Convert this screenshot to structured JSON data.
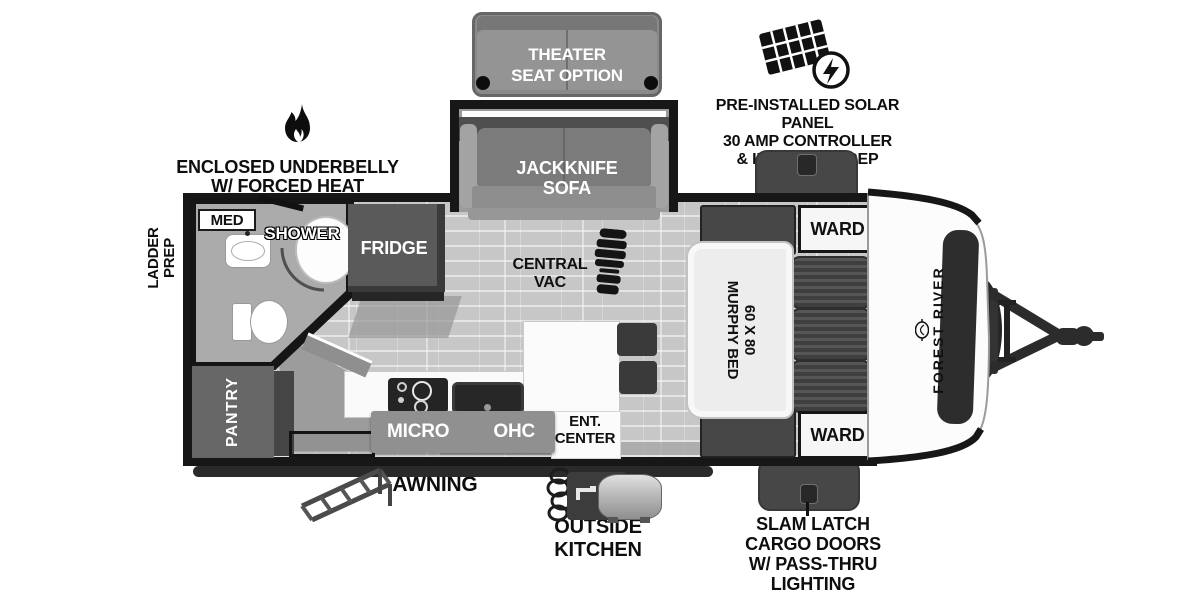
{
  "exterior": {
    "solar": {
      "line1": "PRE-INSTALLED SOLAR PANEL",
      "line2": "30 AMP CONTROLLER",
      "line3": "& INVERTER PREP"
    },
    "underbelly": {
      "line1": "ENCLOSED UNDERBELLY",
      "line2": "W/ FORCED HEAT"
    },
    "ladder": {
      "line1": "LADDER",
      "line2": "PREP"
    },
    "awning": "AWNING",
    "outside_kitchen": {
      "line1": "OUTSIDE",
      "line2": "KITCHEN"
    },
    "slam_latch": {
      "line1": "SLAM LATCH",
      "line2": "CARGO DOORS",
      "line3": "W/ PASS-THRU",
      "line4": "LIGHTING"
    },
    "brand": "FOREST RIVER"
  },
  "interior": {
    "theater": {
      "line1": "THEATER",
      "line2": "SEAT OPTION"
    },
    "jackknife": {
      "line1": "JACKKNIFE",
      "line2": "SOFA"
    },
    "central_vac": {
      "line1": "CENTRAL",
      "line2": "VAC"
    },
    "murphy": {
      "line1": "60 X 80",
      "line2": "MURPHY BED"
    },
    "ward_top": "WARD",
    "ward_bottom": "WARD",
    "med": "MED",
    "shower": "SHOWER",
    "fridge": "FRIDGE",
    "pantry": "PANTRY",
    "micro": "MICRO",
    "ohc": "OHC",
    "ent": {
      "line1": "ENT.",
      "line2": "CENTER"
    }
  },
  "icons": {
    "solar": "solar-panel-icon",
    "flame": "flame-icon",
    "boot": "boot-print-icon",
    "emblem": "forest-river-emblem-icon"
  },
  "colors": {
    "wall": "#171717",
    "floor_plank": "#c7c7c7",
    "bath_floor": "#ababab",
    "dark_furniture": "#474747",
    "sofa_gray": "#7c7c7c",
    "white_fixture": "#f6f6f6"
  }
}
